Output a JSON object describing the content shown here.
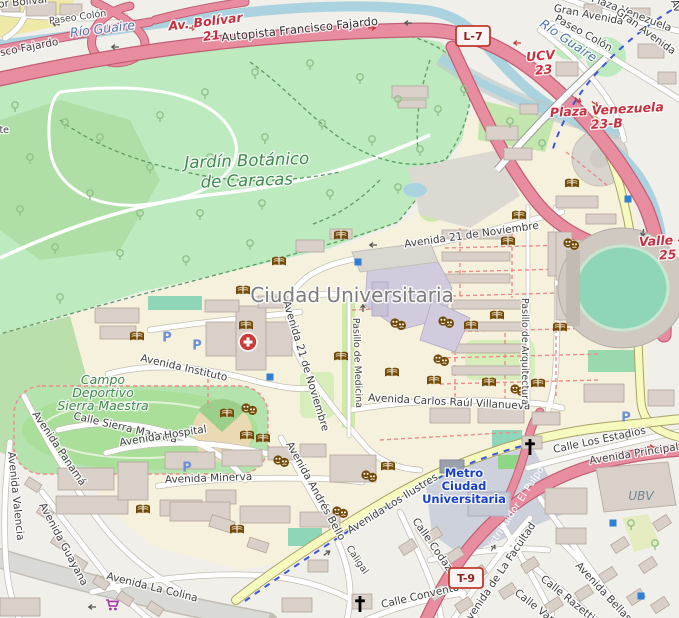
{
  "map": {
    "region": "Ciudad Universitaria / Jardín Botánico, Caracas",
    "colors": {
      "motorway": "#e88da0",
      "motorway_casing": "#c25e74",
      "secondary": "#f7fabf",
      "water": "#aad3df",
      "park": "#bdeabe",
      "campus": "#f6f1dc",
      "building": "#d9d0c9",
      "metro_blue": "#1840c8",
      "exit_red": "#c8303f",
      "poi_brown": "#734a08",
      "parking_blue": "#5f7fd6"
    },
    "shields": [
      {
        "t": "L-7",
        "x": 473,
        "y": 36
      },
      {
        "t": "T-9",
        "x": 466,
        "y": 578
      }
    ],
    "labels": [
      {
        "t": "Distribuidor Bolívar",
        "x": -52,
        "y": 13,
        "r": -6,
        "c": "st",
        "a": "s"
      },
      {
        "t": "Paseo Colón",
        "x": 78,
        "y": 20,
        "r": -8,
        "c": "st-sm",
        "a": "m"
      },
      {
        "t": "Río Guaire",
        "x": 103,
        "y": 33,
        "r": -7,
        "c": "wt",
        "a": "m"
      },
      {
        "t": "Av. Bolívar",
        "x": 206,
        "y": 26,
        "r": -7,
        "c": "ex",
        "a": "m"
      },
      {
        "t": "21",
        "x": 212,
        "y": 40,
        "r": -7,
        "c": "ex",
        "a": "m"
      },
      {
        "t": "Autopista Francisco Fajardo",
        "x": 300,
        "y": 33,
        "r": -6,
        "c": "st-lg",
        "a": "m"
      },
      {
        "t": "Francisco Fajardo",
        "x": -30,
        "y": 62,
        "r": -11,
        "c": "st",
        "a": "s"
      },
      {
        "t": "Puente",
        "x": -24,
        "y": 133,
        "r": 0,
        "c": "st-sm",
        "a": "s"
      },
      {
        "t": "Av. de Plaza Venezuela",
        "x": 614,
        "y": 10,
        "r": 21,
        "c": "st",
        "a": "m"
      },
      {
        "t": "Gran Avenida",
        "x": 588,
        "y": 18,
        "r": 11,
        "c": "st",
        "a": "m"
      },
      {
        "t": "Gran Avenida",
        "x": 644,
        "y": 34,
        "r": 36,
        "c": "st",
        "a": "m"
      },
      {
        "t": "Paseo Colón",
        "x": 582,
        "y": 36,
        "r": 29,
        "c": "st",
        "a": "m"
      },
      {
        "t": "Av",
        "x": 673,
        "y": 7,
        "r": 68,
        "c": "st",
        "a": "m"
      },
      {
        "t": "Río Guaire",
        "x": 566,
        "y": 44,
        "r": 34,
        "c": "wt",
        "a": "m"
      },
      {
        "t": "UCV",
        "x": 541,
        "y": 60,
        "r": -5,
        "c": "ex",
        "a": "m"
      },
      {
        "t": "23",
        "x": 544,
        "y": 74,
        "r": -5,
        "c": "ex",
        "a": "m"
      },
      {
        "t": "Plaza Venezuela",
        "x": 607,
        "y": 114,
        "r": -3,
        "c": "ex",
        "a": "m"
      },
      {
        "t": "23-B",
        "x": 607,
        "y": 128,
        "r": -3,
        "c": "ex",
        "a": "m"
      },
      {
        "t": "Valle -",
        "x": 661,
        "y": 245,
        "r": -3,
        "c": "ex",
        "a": "m"
      },
      {
        "t": "25",
        "x": 668,
        "y": 259,
        "r": -3,
        "c": "ex",
        "a": "m"
      },
      {
        "t": "Jardín Botánico",
        "x": 247,
        "y": 166,
        "r": -2,
        "c": "pk-lg",
        "a": "m"
      },
      {
        "t": "de Caracas",
        "x": 247,
        "y": 186,
        "r": -2,
        "c": "pk-lg",
        "a": "m"
      },
      {
        "t": "Ciudad Universitaria",
        "x": 352,
        "y": 302,
        "r": 0,
        "c": "pl",
        "a": "m"
      },
      {
        "t": "Avenida 21 de Noviembre",
        "x": 472,
        "y": 238,
        "r": -8,
        "c": "st",
        "a": "m"
      },
      {
        "t": "Avenida 21 de Noviembre",
        "x": 283,
        "y": 302,
        "r": 73,
        "c": "st",
        "a": "s"
      },
      {
        "t": "Avenida Instituto",
        "x": 140,
        "y": 361,
        "r": 13,
        "c": "st",
        "a": "s"
      },
      {
        "t": "Campo",
        "x": 103,
        "y": 384,
        "r": 0,
        "c": "pk",
        "a": "m"
      },
      {
        "t": "Deportivo",
        "x": 103,
        "y": 397,
        "r": 0,
        "c": "pk",
        "a": "m"
      },
      {
        "t": "Sierra Maestra",
        "x": 103,
        "y": 410,
        "r": 0,
        "c": "pk",
        "a": "m"
      },
      {
        "t": "Calle Sierra Maestra",
        "x": 73,
        "y": 419,
        "r": 13,
        "c": "st",
        "a": "s"
      },
      {
        "t": "Avenida Hospital",
        "x": 120,
        "y": 446,
        "r": -9,
        "c": "st",
        "a": "s"
      },
      {
        "t": "Avenida Panamá",
        "x": 32,
        "y": 414,
        "r": 56,
        "c": "st",
        "a": "s"
      },
      {
        "t": "Avenida Valencia",
        "x": 8,
        "y": 452,
        "r": 84,
        "c": "st",
        "a": "s"
      },
      {
        "t": "Avenida Guayana",
        "x": 39,
        "y": 505,
        "r": 62,
        "c": "st",
        "a": "s"
      },
      {
        "t": "Avenida La Colina",
        "x": 106,
        "y": 579,
        "r": 14,
        "c": "st",
        "a": "s"
      },
      {
        "t": "Avenida Minerva",
        "x": 165,
        "y": 483,
        "r": -2,
        "c": "st",
        "a": "s"
      },
      {
        "t": "Avenida Andrés Bello",
        "x": 286,
        "y": 444,
        "r": 61,
        "c": "st",
        "a": "s"
      },
      {
        "t": "Avenida Los Ilustres",
        "x": 350,
        "y": 534,
        "r": -32,
        "c": "st",
        "a": "s"
      },
      {
        "t": "Metro",
        "x": 464,
        "y": 477,
        "r": 0,
        "c": "mt",
        "a": "m"
      },
      {
        "t": "Ciudad",
        "x": 464,
        "y": 490,
        "r": 0,
        "c": "mt",
        "a": "m"
      },
      {
        "t": "Universitaria",
        "x": 464,
        "y": 503,
        "r": 0,
        "c": "mt",
        "a": "m"
      },
      {
        "t": "Avenida Carlos Raúl Villanueva",
        "x": 368,
        "y": 401,
        "r": 3,
        "c": "st",
        "a": "s"
      },
      {
        "t": "Pasillo de Medicina",
        "x": 353,
        "y": 318,
        "r": 88,
        "c": "st-sm",
        "a": "s"
      },
      {
        "t": "Pasillo de Arquitectura",
        "x": 522,
        "y": 298,
        "r": 90,
        "c": "st-sm",
        "a": "s"
      },
      {
        "t": "Caligal",
        "x": 346,
        "y": 548,
        "r": 56,
        "c": "st-sm",
        "a": "s"
      },
      {
        "t": "Calle Codazzi",
        "x": 412,
        "y": 521,
        "r": 55,
        "c": "st",
        "a": "s"
      },
      {
        "t": "Calle Convento",
        "x": 382,
        "y": 608,
        "r": -13,
        "c": "st",
        "a": "s"
      },
      {
        "t": "Distribuidor El Pulpo",
        "x": 489,
        "y": 554,
        "r": -57,
        "c": "wh",
        "a": "s"
      },
      {
        "t": "Calle Los Estadios",
        "x": 554,
        "y": 453,
        "r": -12,
        "c": "st",
        "a": "s"
      },
      {
        "t": "Avenida Principal de Bello Monte",
        "x": 590,
        "y": 464,
        "r": -9,
        "c": "st",
        "a": "s"
      },
      {
        "t": "UBV",
        "x": 641,
        "y": 500,
        "r": 0,
        "c": "gy",
        "a": "m"
      },
      {
        "t": "Avenida de La Facultad",
        "x": 468,
        "y": 626,
        "r": -56,
        "c": "st",
        "a": "s"
      },
      {
        "t": "Calle Razetti",
        "x": 540,
        "y": 580,
        "r": 39,
        "c": "st",
        "a": "s"
      },
      {
        "t": "Calle Vargas",
        "x": 514,
        "y": 594,
        "r": 38,
        "c": "st",
        "a": "s"
      },
      {
        "t": "Avenida Bellas Artes",
        "x": 575,
        "y": 566,
        "r": 47,
        "c": "st",
        "a": "s"
      }
    ],
    "icons": {
      "library_books": [
        [
          341,
          236
        ],
        [
          279,
          262
        ],
        [
          508,
          242
        ],
        [
          519,
          216
        ],
        [
          572,
          184
        ],
        [
          243,
          291
        ],
        [
          246,
          326
        ],
        [
          137,
          337
        ],
        [
          227,
          414
        ],
        [
          247,
          436
        ],
        [
          263,
          439
        ],
        [
          341,
          357
        ],
        [
          392,
          373
        ],
        [
          434,
          381
        ],
        [
          471,
          326
        ],
        [
          497,
          316
        ],
        [
          489,
          383
        ],
        [
          538,
          384
        ],
        [
          560,
          328
        ],
        [
          388,
          467
        ],
        [
          143,
          510
        ],
        [
          237,
          530
        ]
      ],
      "theatre_masks": [
        [
          398,
          324
        ],
        [
          446,
          322
        ],
        [
          441,
          360
        ],
        [
          249,
          409
        ],
        [
          281,
          461
        ],
        [
          518,
          390
        ],
        [
          571,
          244
        ],
        [
          369,
          476
        ],
        [
          340,
          512
        ]
      ],
      "hospital": [
        [
          248,
          342
        ]
      ],
      "church": [
        [
          360,
          604
        ],
        [
          530,
          447
        ]
      ],
      "supermarket_cart": [
        [
          112,
          605
        ]
      ],
      "parking": [
        [
          167,
          337
        ],
        [
          197,
          345
        ],
        [
          187,
          467
        ],
        [
          626,
          417
        ]
      ],
      "viewpoint_square": [
        [
          358,
          262
        ],
        [
          270,
          377
        ],
        [
          628,
          199
        ],
        [
          613,
          523
        ],
        [
          641,
          596
        ]
      ],
      "trees": [
        [
          30,
          160
        ],
        [
          65,
          125
        ],
        [
          15,
          108
        ],
        [
          100,
          140
        ],
        [
          160,
          118
        ],
        [
          205,
          95
        ],
        [
          255,
          75
        ],
        [
          310,
          66
        ],
        [
          360,
          80
        ],
        [
          398,
          102
        ],
        [
          150,
          170
        ],
        [
          210,
          160
        ],
        [
          265,
          140
        ],
        [
          322,
          126
        ],
        [
          372,
          142
        ],
        [
          420,
          152
        ],
        [
          90,
          196
        ],
        [
          140,
          216
        ],
        [
          200,
          216
        ],
        [
          262,
          206
        ],
        [
          330,
          196
        ],
        [
          398,
          190
        ],
        [
          55,
          250
        ],
        [
          120,
          256
        ],
        [
          186,
          262
        ],
        [
          250,
          246
        ],
        [
          60,
          300
        ],
        [
          20,
          212
        ],
        [
          438,
          112
        ],
        [
          464,
          92
        ],
        [
          510,
          124
        ],
        [
          542,
          146
        ],
        [
          631,
          526
        ],
        [
          655,
          546
        ]
      ],
      "oneway_arrows": [
        {
          "x": 115,
          "y": 47,
          "r": 180,
          "red": 0
        },
        {
          "x": 56,
          "y": 24,
          "r": 195,
          "red": 0
        },
        {
          "x": 192,
          "y": 28,
          "r": 0,
          "red": 1
        },
        {
          "x": 372,
          "y": 28,
          "r": 0,
          "red": 1
        },
        {
          "x": 408,
          "y": 23,
          "r": 180,
          "red": 0
        },
        {
          "x": 517,
          "y": 43,
          "r": 180,
          "red": 1
        },
        {
          "x": 578,
          "y": 100,
          "r": 38,
          "red": 1
        },
        {
          "x": 595,
          "y": 104,
          "r": 38,
          "red": 1
        },
        {
          "x": 643,
          "y": 233,
          "r": 100,
          "red": 0
        },
        {
          "x": 628,
          "y": 437,
          "r": 180,
          "red": 0
        },
        {
          "x": 650,
          "y": 447,
          "r": 0,
          "red": 1
        },
        {
          "x": 493,
          "y": 548,
          "r": -55,
          "red": 0
        },
        {
          "x": 317,
          "y": 405,
          "r": 118,
          "red": 0
        },
        {
          "x": 373,
          "y": 245,
          "r": 180,
          "red": 0
        },
        {
          "x": 92,
          "y": 607,
          "r": 180,
          "red": 0
        },
        {
          "x": 327,
          "y": 553,
          "r": -35,
          "red": 0
        },
        {
          "x": 363,
          "y": 308,
          "r": -90,
          "red": 0
        }
      ]
    }
  }
}
